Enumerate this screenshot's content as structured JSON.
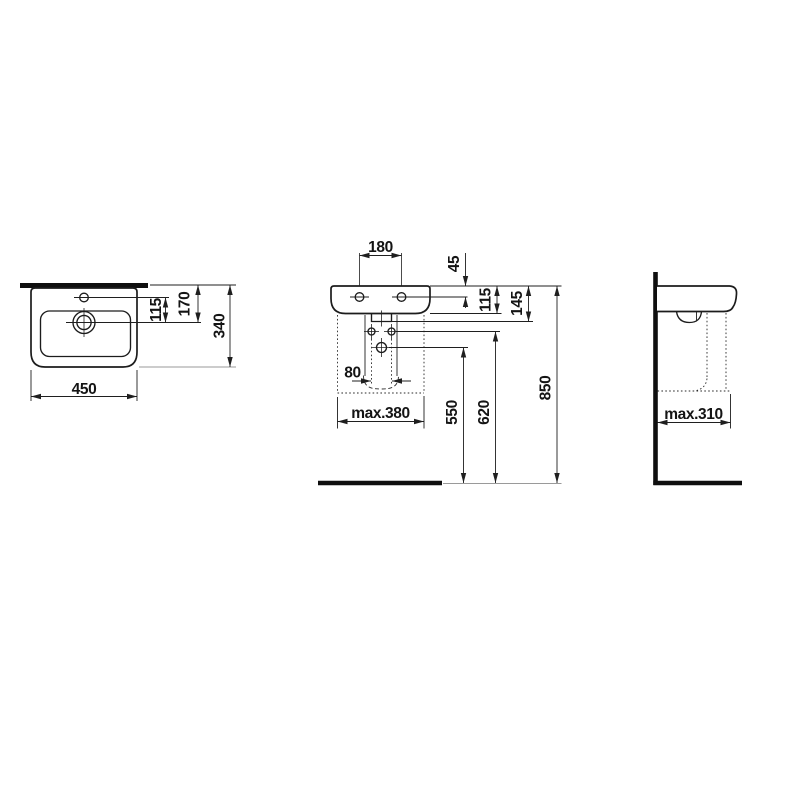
{
  "drawing": {
    "description": "Washbasin technical installation drawing, three views",
    "colors": {
      "line": "#1f1f1f",
      "background": "#ffffff",
      "light_extension": "#9a9a9a"
    },
    "views": {
      "top": {
        "label": "top-view",
        "dims": {
          "width": "450",
          "depth": "340",
          "tap_to_drain": "115",
          "front_to_drain": "170"
        }
      },
      "front": {
        "label": "front-view",
        "dims": {
          "tap_spacing": "180",
          "rim_to_fixing": "45",
          "rim_to_underside": "115",
          "rim_to_outlet": "145",
          "supply_spacing": "80",
          "zone_width": "max.380",
          "outlet_height": "550",
          "supply_height": "620",
          "rim_height": "850"
        }
      },
      "side": {
        "label": "side-view",
        "dims": {
          "zone_depth": "max.310"
        }
      }
    }
  }
}
